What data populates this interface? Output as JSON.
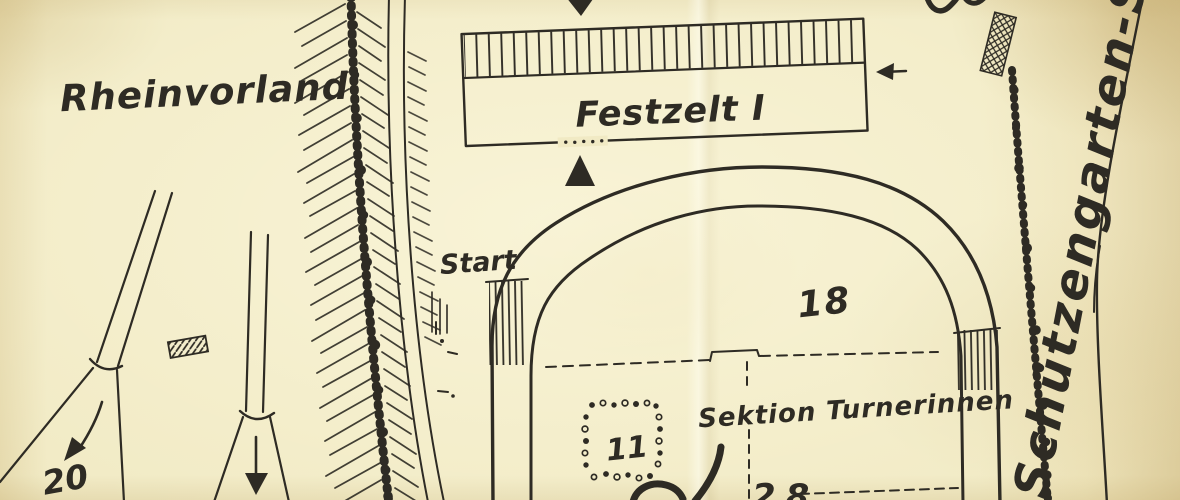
{
  "map": {
    "labels": {
      "rheinvorland": "Rheinvorland",
      "festzelt": "Festzelt I",
      "start": "Start",
      "sektion_turnerinnen": "Sektion Turnerinnen",
      "street": "Schützengarten-Str"
    },
    "numbers": {
      "zone18": "18",
      "zone11": "11",
      "zone20": "20",
      "zone28": "28"
    },
    "icons": {
      "arrow_down": "▼",
      "arrow_up": "▲",
      "arrow_left": "←",
      "arrow_down_left": "↙"
    },
    "colors": {
      "paper": "#f1eac4",
      "paper_shade": "#e5d7a7",
      "ink": "#2e2b24"
    }
  }
}
